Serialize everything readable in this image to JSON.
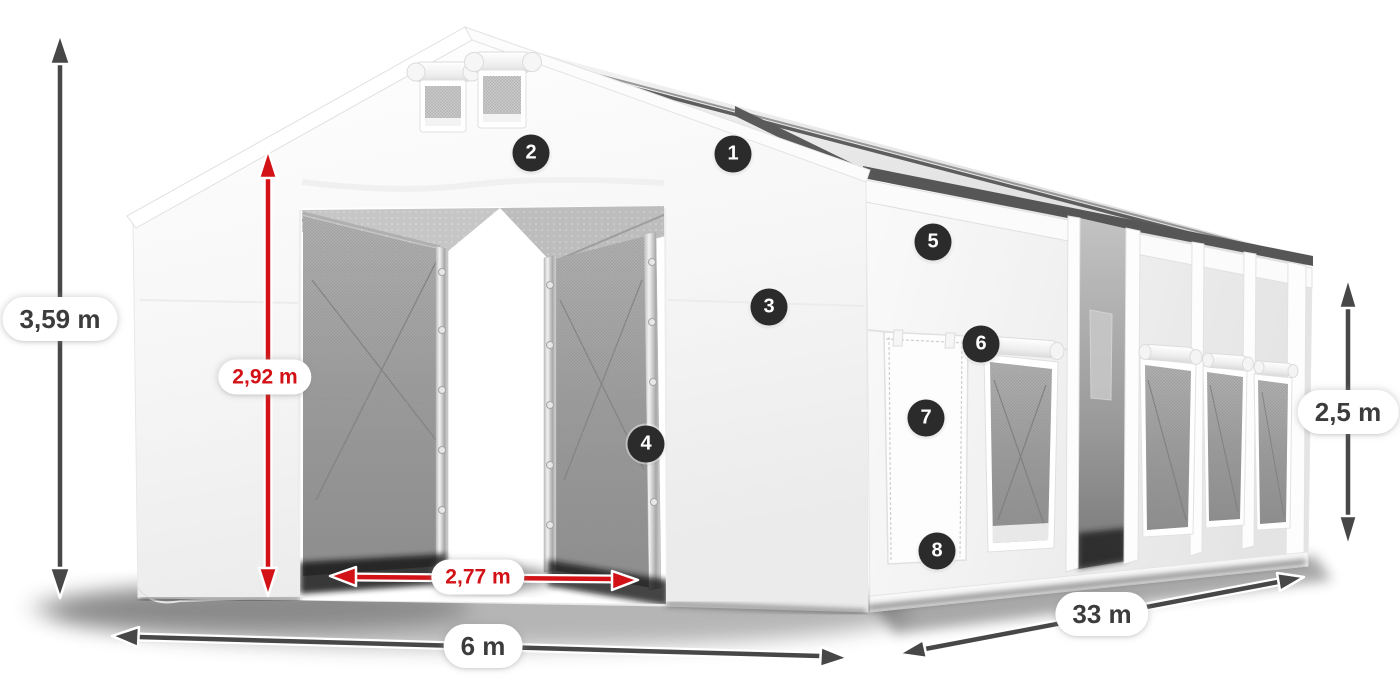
{
  "illustration": {
    "subject": "white-storage-tent-3d-render",
    "view": "front-left perspective with open gable entrance and long side wall"
  },
  "dimensions": {
    "total_height": "3,59 m",
    "entrance_height": "2,92 m",
    "entrance_width": "2,77 m",
    "width": "6 m",
    "length": "33 m",
    "side_height": "2,5 m"
  },
  "callouts": [
    "1",
    "2",
    "3",
    "4",
    "5",
    "6",
    "7",
    "8"
  ],
  "colors": {
    "arrow_dark": "#474747",
    "arrow_red": "#d21216",
    "label_text_dark": "#3c3c3c",
    "label_text_red": "#d21216",
    "label_background": "#ffffff",
    "badge_background": "#2b2b2b",
    "badge_text": "#ffffff",
    "tent_fabric": "#f7f7f7",
    "mesh_panel": "#9c9c9c",
    "background": "#ffffff"
  }
}
